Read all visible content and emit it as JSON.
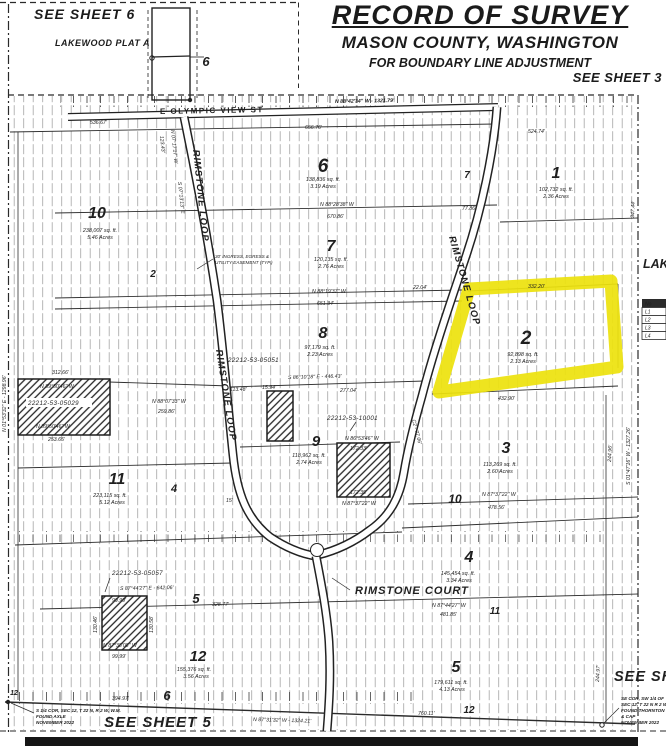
{
  "header": {
    "see_sheet_6": "SEE SHEET 6",
    "lakewood_plat_a": "LAKEWOOD PLAT A",
    "title": "RECORD OF SURVEY",
    "subtitle": "MASON COUNTY, WASHINGTON",
    "subtitle2": "FOR BOUNDARY LINE ADJUSTMENT",
    "see_sheet_3": "SEE SHEET 3",
    "inset_lot": "6"
  },
  "map": {
    "highlight_color": "#ede20e",
    "streets": {
      "olympic": "E OLYMPIC VIEW ST",
      "loop_west": "RIMSTONE LOOP",
      "loop_mid": "RIMSTONE LOOP",
      "loop_east": "RIMSTONE LOOP",
      "court": "RIMSTONE COURT"
    },
    "lots": [
      {
        "num": "6",
        "sqft": "138,836 sq. ft.",
        "acres": "3.19 Acres"
      },
      {
        "num": "7",
        "sqft": "120,135 sq. ft.",
        "acres": "2.76 Acres"
      },
      {
        "num": "1",
        "sqft": "102,732 sq. ft.",
        "acres": "2.36 Acres"
      },
      {
        "num": "10",
        "sqft": "238,007 sq. ft.",
        "acres": "5.46 Acres"
      },
      {
        "num": "8",
        "sqft": "97,179 sq. ft.",
        "acres": "2.23 Acres"
      },
      {
        "num": "2",
        "sqft": "92,898 sq. ft.",
        "acres": "2.13 Acres"
      },
      {
        "num": "9",
        "sqft": "118,962 sq. ft.",
        "acres": "2.74 Acres"
      },
      {
        "num": "3",
        "sqft": "113,269 sq. ft.",
        "acres": "2.60 Acres"
      },
      {
        "num": "11",
        "sqft": "223,115 sq. ft.",
        "acres": "5.12 Acres"
      },
      {
        "num": "4",
        "sqft": "145,454 sq. ft.",
        "acres": "3.34 Acres"
      },
      {
        "num": "12",
        "sqft": "155,376 sq. ft.",
        "acres": "3.56 Acres"
      },
      {
        "num": "5",
        "sqft": "179,611 sq. ft.",
        "acres": "4.13 Acres"
      }
    ],
    "plat_numbers": [
      "2",
      "7",
      "4",
      "10",
      "11",
      "12",
      "6",
      "12",
      "5"
    ],
    "tax_parcels": [
      "22212-53-05029",
      "22212-53-05051",
      "22212-53-10001",
      "22212-53-05057"
    ],
    "easement_note_1": "30' INGRESS, EGRESS &",
    "easement_note_2": "UTILITY EASEMENT (TYP.)",
    "dims": [
      "N 88°42'34\" W  -  1321.79'",
      "536.67'",
      "656.76'",
      "524.74'",
      "123.43'",
      "N 07°17'17\" W",
      "S 07°13'13\" E",
      "77.86'",
      "N 88°28'38\" W",
      "670.86'",
      "347.44'",
      "N 88°19'37\" W",
      "651.34'",
      "22.04'",
      "332.20'",
      "S 86°10'18\" E  -  446.43'",
      "277.04'",
      "15.94'",
      "113.48'",
      "N 88°07'33\" W",
      "259.86'",
      "312.66'",
      "N 89°50'46\" W",
      "N 89°50'46\" W",
      "253.65'",
      "N 01°53'32\" E - 1298.96'",
      "432.90'",
      "172.33'",
      "172.35'",
      "N 87°37'22\" W",
      "N 86°53'46\" W",
      "N 87°37'22\" W",
      "478.56'",
      "244.96'",
      "S 01°47'16\" W - 1327.26'",
      "S 87°44'27\" E  -  642.06'",
      "328.77'",
      "N 87°44'27\" W",
      "481.85'",
      "N 87°31'32\" W  -  1324.21'",
      "394.97'",
      "760.11'",
      "244.97'",
      "99.99'",
      "N 87°38'08\" W",
      "99.99'",
      "130.46'",
      "130.58'",
      "15'",
      "C2 - 77.06'"
    ],
    "corner_note_sw": [
      "S 1/4 COR, SEC 12, T 22 N, R 2 W, W.M.",
      "FOUND AXLE",
      "NOVEMBER 2022"
    ],
    "corner_note_se": [
      "SE COR, SW 1/4 OF",
      "SEC 12, T 22 N R 2 W",
      "FOUND THORNTON",
      "& CAP",
      "NOVEMBER 2022"
    ],
    "see_sheet_5": "SEE SHEET 5",
    "see_sheet_right": "SEE SHEET",
    "lakewood_right": "LAKE",
    "line_table": {
      "header": "No",
      "rows": [
        "L1",
        "L2",
        "L3",
        "L4"
      ]
    }
  }
}
